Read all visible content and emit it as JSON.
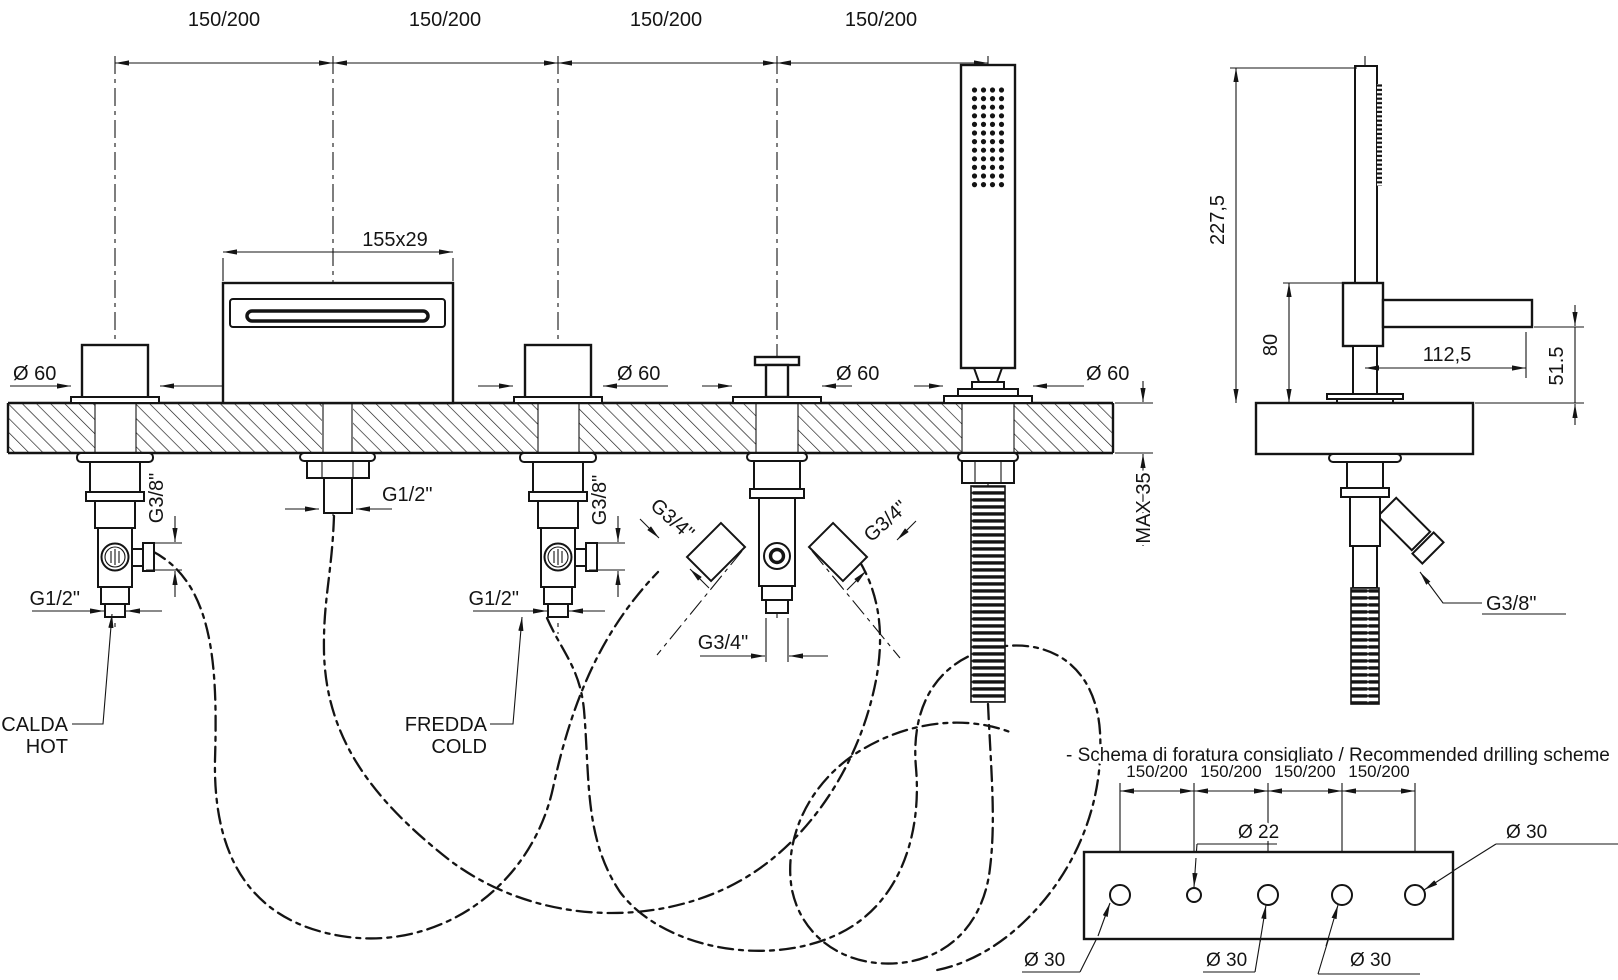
{
  "front_view": {
    "pitch_labels": [
      "150/200",
      "150/200",
      "150/200",
      "150/200"
    ],
    "spout_dim": "155x29",
    "escutcheon_dia": "Ø 60",
    "hot": {
      "side_thread": "G3/8\"",
      "bottom_thread": "G1/2\"",
      "name_it": "CALDA",
      "name_en": "HOT"
    },
    "cold": {
      "side_thread": "G3/8\"",
      "bottom_thread": "G1/2\"",
      "name_it": "FREDDA",
      "name_en": "COLD"
    },
    "spout_thread": "G1/2\"",
    "diverter": {
      "left_thread": "G3/4\"",
      "right_thread": "G3/4\"",
      "bottom_thread": "G3/4\""
    },
    "deck_thickness": "MAX 35"
  },
  "side_view": {
    "total_height": "227,5",
    "body_height": "80",
    "spout_reach": "112,5",
    "spout_drop": "51.5",
    "hose_thread": "G3/8\""
  },
  "drilling": {
    "title": "- Schema di foratura consigliato / Recommended drilling scheme",
    "pitch_labels": [
      "150/200",
      "150/200",
      "150/200",
      "150/200"
    ],
    "small_hole": "Ø 22",
    "large_hole": "Ø 30"
  },
  "colors": {
    "line": "#141414",
    "background": "#ffffff"
  }
}
